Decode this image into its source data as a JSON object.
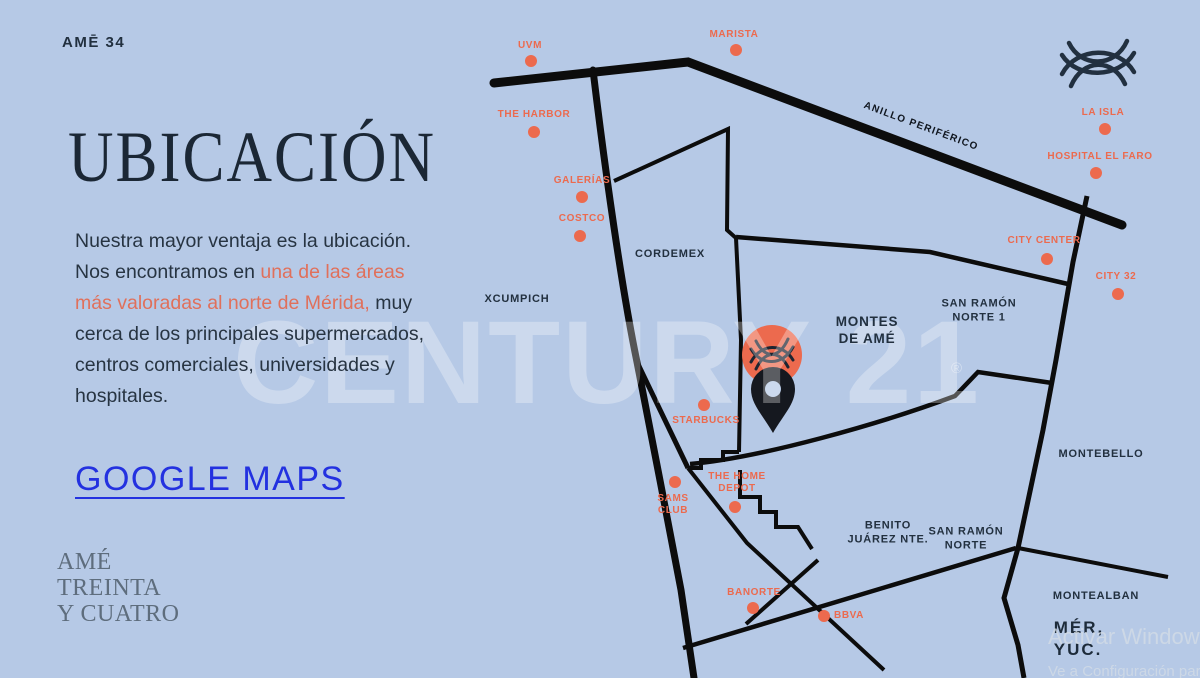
{
  "colors": {
    "background": "#b6c9e6",
    "accent_orange": "#ec6a4e",
    "navy_text": "#22303f",
    "link_blue": "#2331e0",
    "road_black": "#0c0c0c",
    "logo_gray": "#5e6d7d"
  },
  "header": {
    "wordmark": "AMĒ 34"
  },
  "left_panel": {
    "title": "UBICACIÓN",
    "paragraph": {
      "part1": "Nuestra mayor ventaja es la ubicación. Nos encontramos en ",
      "highlight": "una de las áreas más valoradas al norte de Mérida,",
      "part2": " muy cerca de los principales supermercados, centros comerciales, universidades y hospitales."
    },
    "link": "GOOGLE MAPS",
    "logo_lines": [
      "AMÉ",
      "TREINTA",
      "Y CUATRO"
    ]
  },
  "map": {
    "watermark": "CENTURY 21",
    "watermark_symbol": "®",
    "road_label": "ANILLO PERIFÉRICO",
    "pois": [
      {
        "label": [
          "UVM"
        ],
        "label_x": 530,
        "label_y": 46,
        "dot_x": 531,
        "dot_y": 61
      },
      {
        "label": [
          "MARISTA"
        ],
        "label_x": 734,
        "label_y": 35,
        "dot_x": 736,
        "dot_y": 50
      },
      {
        "label": [
          "THE HARBOR"
        ],
        "label_x": 534,
        "label_y": 115,
        "dot_x": 534,
        "dot_y": 132
      },
      {
        "label": [
          "GALERÍAS"
        ],
        "label_x": 582,
        "label_y": 181,
        "dot_x": 582,
        "dot_y": 197
      },
      {
        "label": [
          "COSTCO"
        ],
        "label_x": 582,
        "label_y": 219,
        "dot_x": 580,
        "dot_y": 236
      },
      {
        "label": [
          "LA ISLA"
        ],
        "label_x": 1103,
        "label_y": 113,
        "dot_x": 1105,
        "dot_y": 129
      },
      {
        "label": [
          "HOSPITAL EL FARO"
        ],
        "label_x": 1100,
        "label_y": 157,
        "dot_x": 1096,
        "dot_y": 173
      },
      {
        "label": [
          "CITY CENTER"
        ],
        "label_x": 1044,
        "label_y": 241,
        "dot_x": 1047,
        "dot_y": 259
      },
      {
        "label": [
          "CITY 32"
        ],
        "label_x": 1116,
        "label_y": 277,
        "dot_x": 1118,
        "dot_y": 294
      },
      {
        "label": [
          "STARBUCKS"
        ],
        "label_x": 706,
        "label_y": 421,
        "dot_x": 704,
        "dot_y": 405
      },
      {
        "label": [
          "THE HOME",
          "DEPOT"
        ],
        "label_x": 737,
        "label_y": 483,
        "dot_x": 735,
        "dot_y": 507
      },
      {
        "label": [
          "SAMS",
          "CLUB"
        ],
        "label_x": 673,
        "label_y": 505,
        "dot_x": 675,
        "dot_y": 482
      },
      {
        "label": [
          "BANORTE"
        ],
        "label_x": 754,
        "label_y": 593,
        "dot_x": 753,
        "dot_y": 608
      },
      {
        "label": [
          "BBVA"
        ],
        "label_x": 849,
        "label_y": 616,
        "dot_x": 824,
        "dot_y": 616
      }
    ],
    "areas": [
      {
        "label": [
          "CORDEMEX"
        ],
        "x": 670,
        "y": 255,
        "size": 11
      },
      {
        "label": [
          "XCUMPICH"
        ],
        "x": 517,
        "y": 300,
        "size": 11
      },
      {
        "label": [
          "MONTES",
          "DE AMÉ"
        ],
        "x": 867,
        "y": 331,
        "size": 13.5
      },
      {
        "label": [
          "SAN RAMÓN",
          "NORTE 1"
        ],
        "x": 979,
        "y": 311,
        "size": 11
      },
      {
        "label": [
          "BENITO",
          "JUÁREZ NTE."
        ],
        "x": 888,
        "y": 533,
        "size": 11
      },
      {
        "label": [
          "SAN RAMÓN",
          "NORTE"
        ],
        "x": 966,
        "y": 539,
        "size": 11
      },
      {
        "label": [
          "MONTEBELLO"
        ],
        "x": 1101,
        "y": 455,
        "size": 11
      },
      {
        "label": [
          "MONTEALBAN"
        ],
        "x": 1096,
        "y": 597,
        "size": 11
      },
      {
        "label": [
          "MÉR,",
          "YUC."
        ],
        "x": 1079,
        "y": 639,
        "size": 17,
        "big": true
      }
    ]
  },
  "system": {
    "activation_line1": "Activar Windows",
    "activation_line2": "Ve a Configuración para activar Windows."
  }
}
